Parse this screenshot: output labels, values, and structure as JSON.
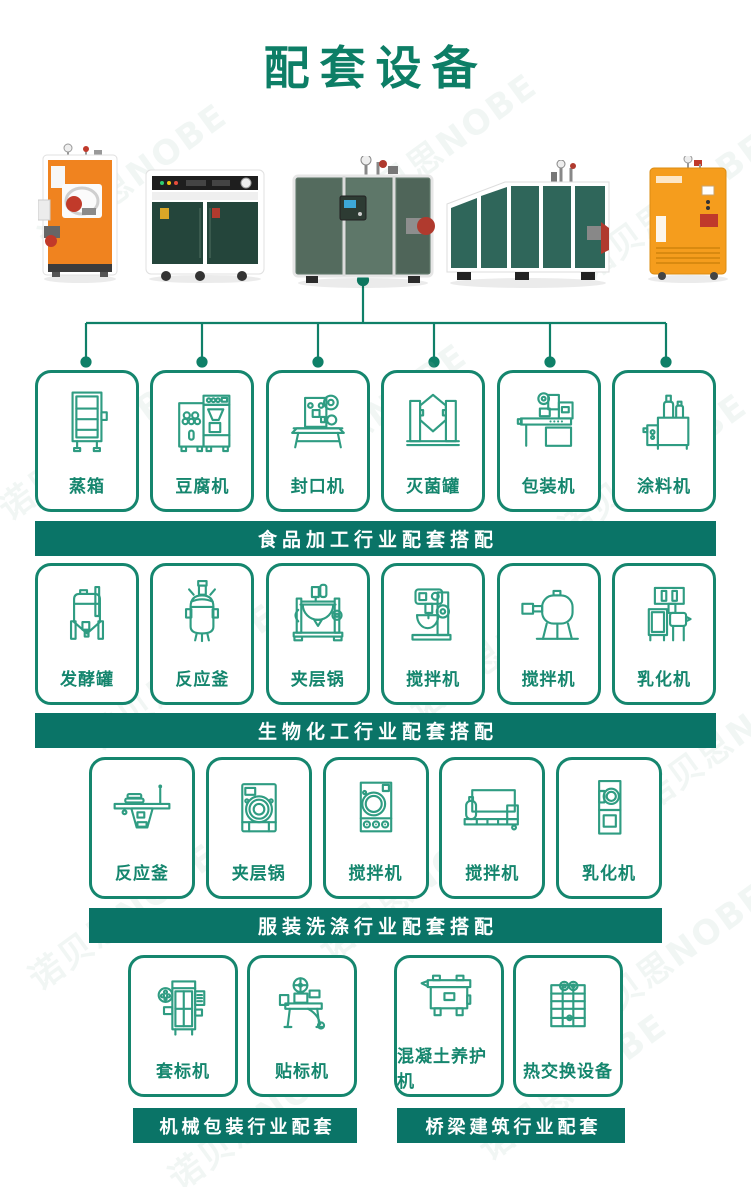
{
  "title": "配套设备",
  "watermark": {
    "text": "诺贝思NOBE"
  },
  "colors": {
    "title_green": "#0d7e66",
    "banner_green": "#0a7467",
    "card_border_green": "#15866e",
    "icon_stroke_green": "#2f9c82",
    "machine_orange": "#f0831f",
    "machine_dark_green": "#24453b",
    "machine_sage_green": "#5b7365",
    "machine_teal_green": "#2f665a"
  },
  "machines": [
    {
      "name": "vertical-steam-generator-orange"
    },
    {
      "name": "cabinet-steam-boiler-dark-green"
    },
    {
      "name": "cube-steam-generator-green"
    },
    {
      "name": "horizontal-steam-boiler-green"
    },
    {
      "name": "cabinet-steam-generator-orange"
    }
  ],
  "sections": [
    {
      "banner": "食品加工行业配套搭配",
      "items": [
        {
          "label": "蒸箱",
          "icon": "steam-cabinet-icon"
        },
        {
          "label": "豆腐机",
          "icon": "tofu-machine-icon"
        },
        {
          "label": "封口机",
          "icon": "sealing-machine-icon"
        },
        {
          "label": "灭菌罐",
          "icon": "sterilizer-tank-icon"
        },
        {
          "label": "包装机",
          "icon": "packing-machine-icon"
        },
        {
          "label": "涂料机",
          "icon": "coating-machine-icon"
        }
      ]
    },
    {
      "banner": "生物化工行业配套搭配",
      "items": [
        {
          "label": "发酵罐",
          "icon": "fermenter-tank-icon"
        },
        {
          "label": "反应釜",
          "icon": "reaction-kettle-icon"
        },
        {
          "label": "夹层锅",
          "icon": "jacketed-kettle-icon"
        },
        {
          "label": "搅拌机",
          "icon": "planetary-mixer-icon"
        },
        {
          "label": "搅拌机",
          "icon": "drum-mixer-icon"
        },
        {
          "label": "乳化机",
          "icon": "emulsifier-icon"
        }
      ]
    },
    {
      "banner": "服装洗涤行业配套搭配",
      "items": [
        {
          "label": "反应釜",
          "icon": "ironing-table-icon"
        },
        {
          "label": "夹层锅",
          "icon": "washer-machine-icon"
        },
        {
          "label": "搅拌机",
          "icon": "dryer-machine-icon"
        },
        {
          "label": "搅拌机",
          "icon": "flatwork-machine-icon"
        },
        {
          "label": "乳化机",
          "icon": "vertical-dryer-icon"
        }
      ]
    },
    {
      "banner": "机械包装行业配套",
      "items": [
        {
          "label": "套标机",
          "icon": "labeling-machine-icon"
        },
        {
          "label": "贴标机",
          "icon": "sticker-labeler-icon"
        }
      ]
    },
    {
      "banner": "桥梁建筑行业配套",
      "items": [
        {
          "label": "混凝土养护机",
          "icon": "concrete-curing-machine-icon"
        },
        {
          "label": "热交换设备",
          "icon": "heat-exchanger-icon"
        }
      ]
    }
  ]
}
